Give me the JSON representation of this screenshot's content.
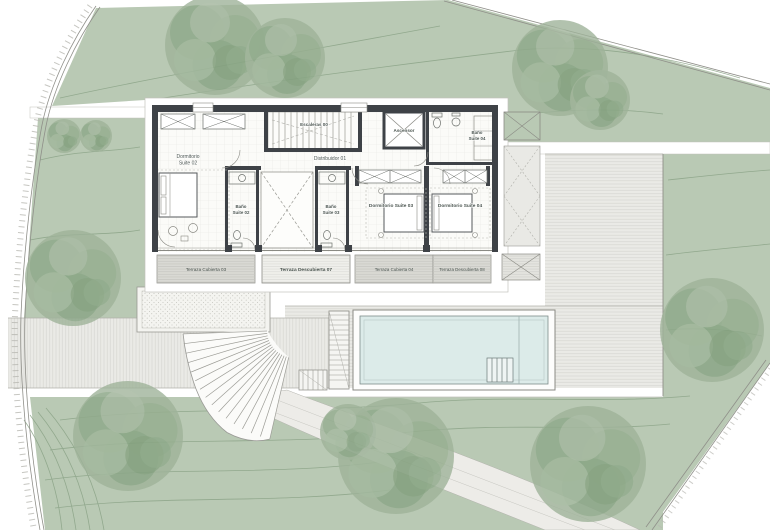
{
  "plan": {
    "kind": "architectural floor plan, upper floor with pool and landscaped plot",
    "language": "Spanish"
  },
  "colors": {
    "terrain_green": "#b9c9b4",
    "tree_green": "#93ab8e",
    "contour_green": "#8ba387",
    "wall_dark": "#3e4247",
    "pool_water": "#dcebe9",
    "deck_gray": "#eaeae6",
    "terrace_panel_gray": "#d9d9d4",
    "label_ink": "#4b5550"
  },
  "rooms": {
    "dormitorio2_line1": "Dormitorio",
    "dormitorio2_line2": "Suite 02",
    "escaleras": "Escaleras 00",
    "distribuidor": "Distribuidor 01",
    "ascensor": "Ascensor",
    "bano4_line1": "Baño",
    "bano4_line2": "Suite 04",
    "bano2_line1": "Baño",
    "bano2_line2": "Suite 02",
    "bano3_line1": "Baño",
    "bano3_line2": "Suite 03",
    "dormitorio3": "Dormitorio Suite 03",
    "dormitorio4": "Dormitorio Suite 04"
  },
  "terraces": {
    "cubierta3": "Terraza Cubierta 03",
    "descubierta7": "Terraza Descubierta 07",
    "cubierta4": "Terraza Cubierta 04",
    "descubierta8": "Terraza Descubierta 08"
  }
}
